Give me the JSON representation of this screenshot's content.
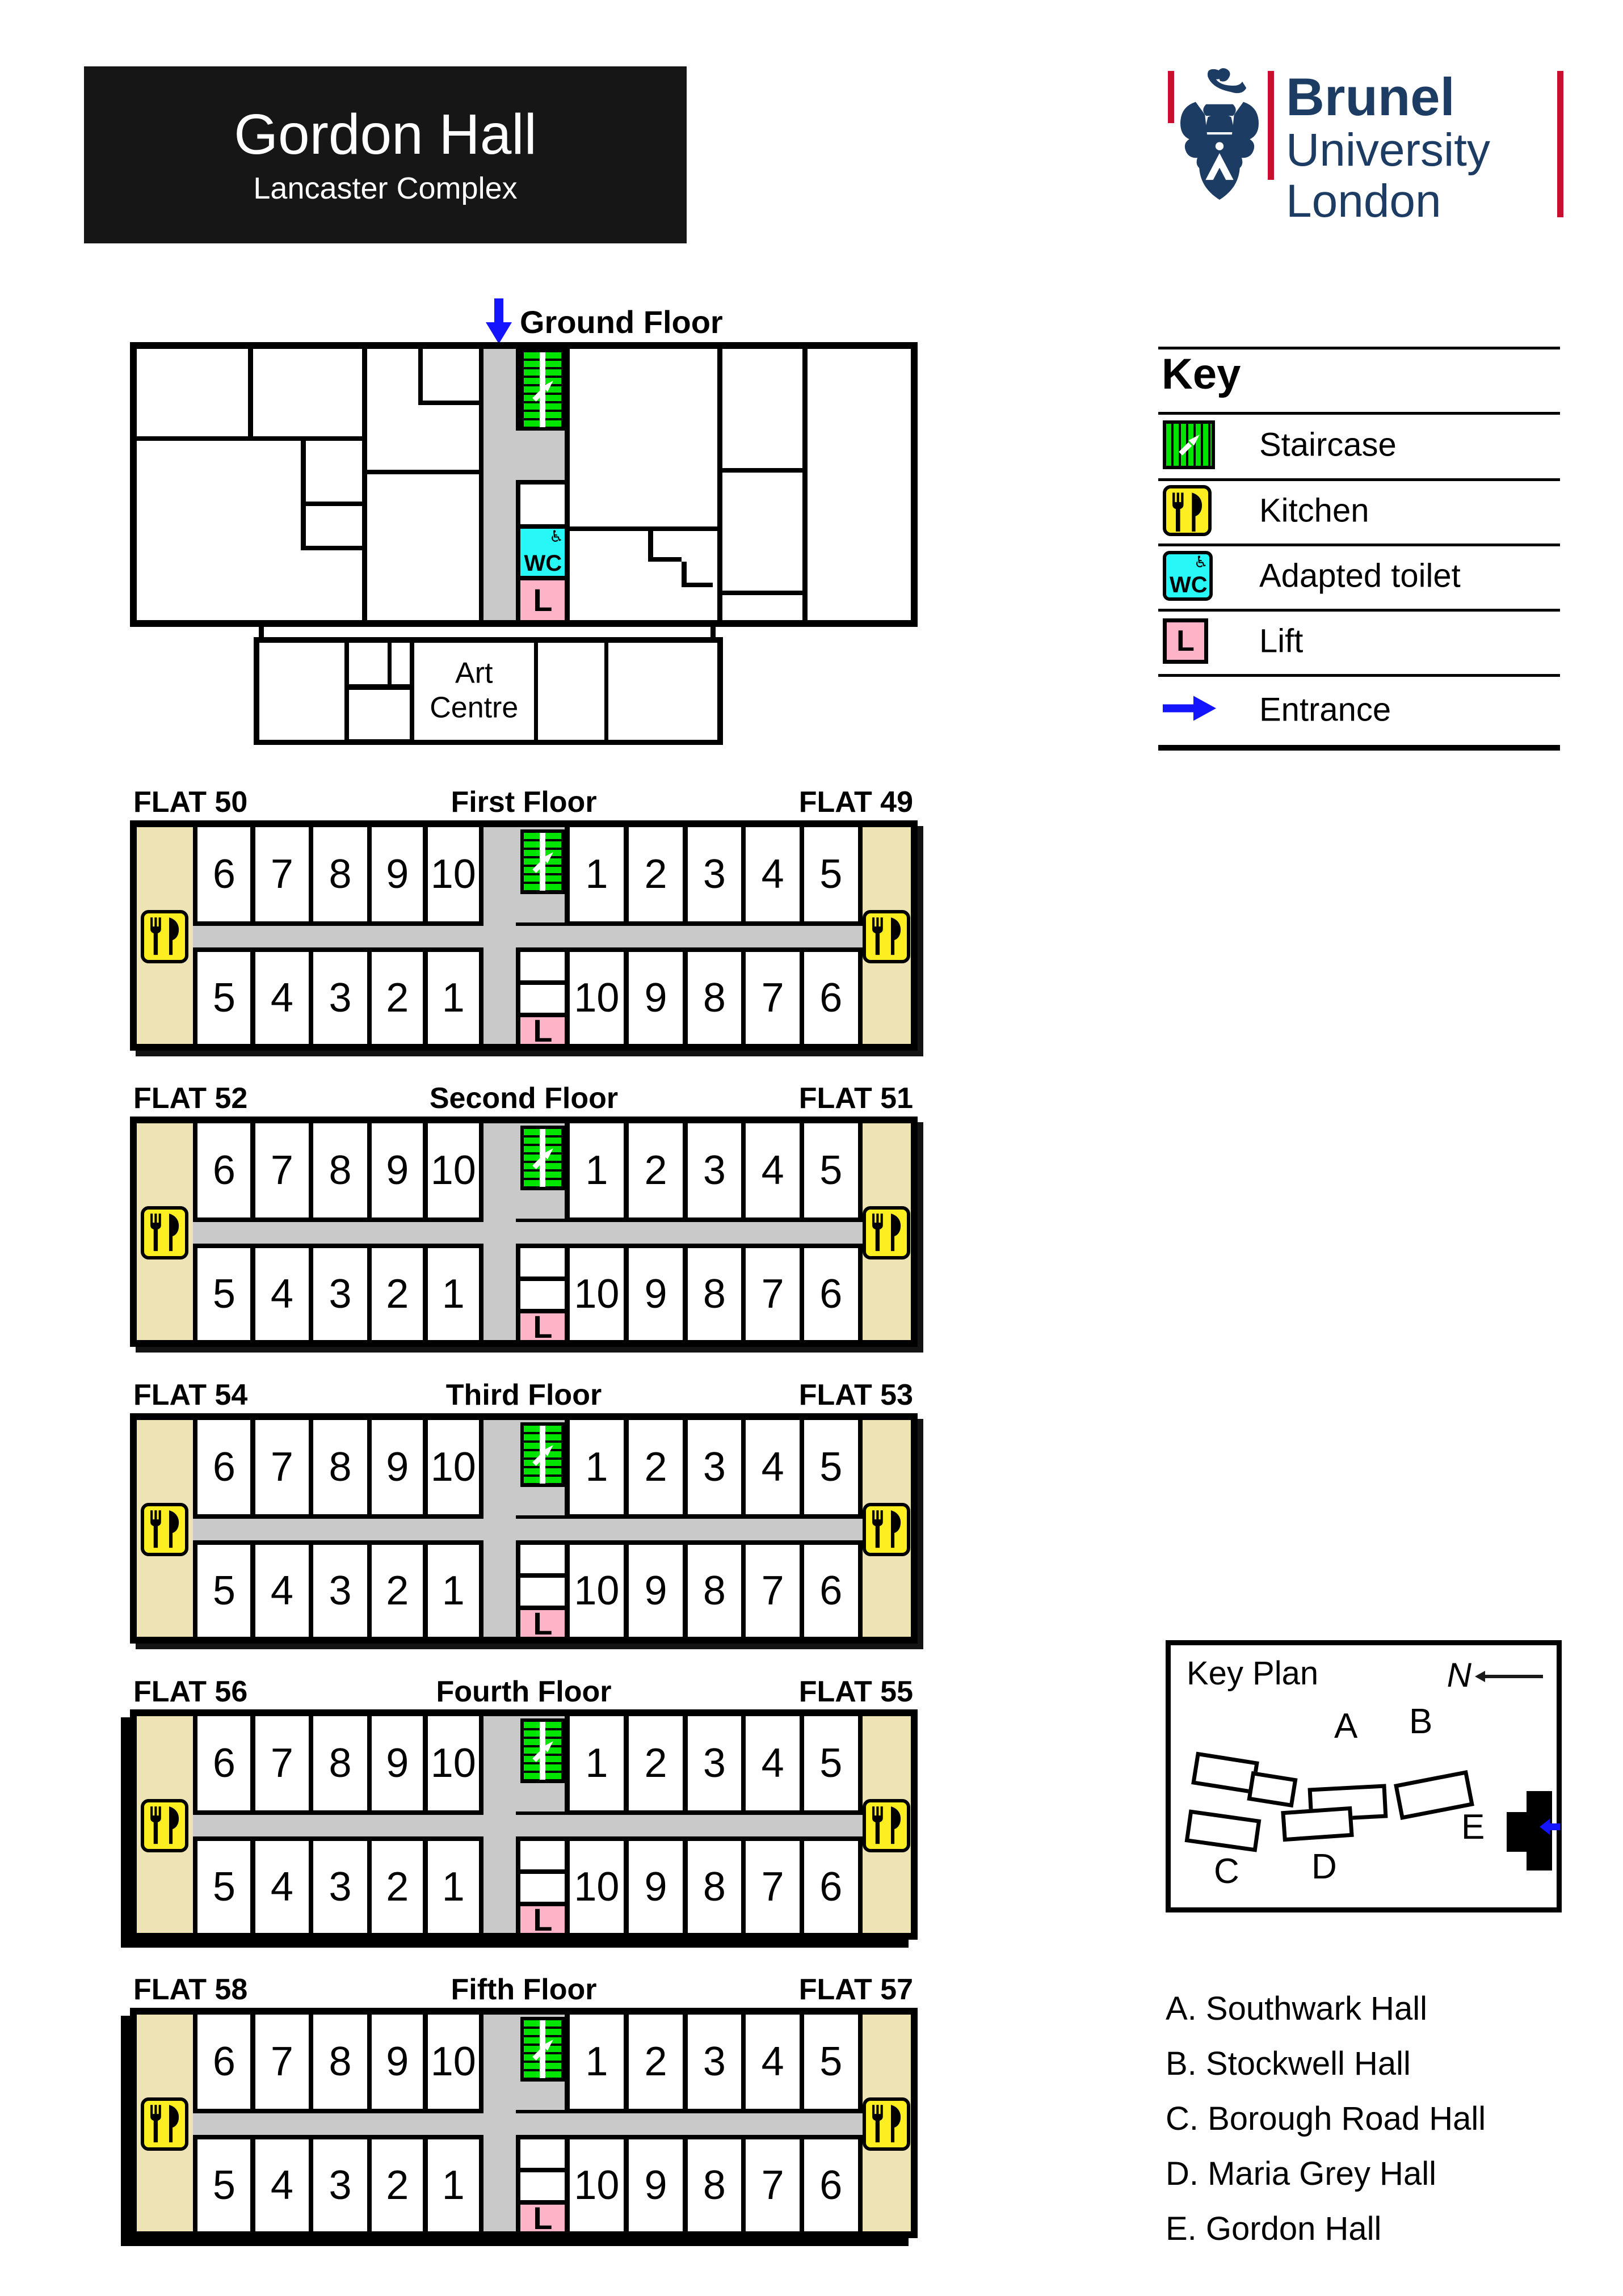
{
  "title_block": {
    "title": "Gordon Hall",
    "subtitle": "Lancaster Complex"
  },
  "logo": {
    "line1": "Brunel",
    "line2": "University",
    "line3": "London"
  },
  "ground_floor": {
    "label": "Ground Floor",
    "art_centre": "Art\nCentre",
    "wc": "WC",
    "lift": "L"
  },
  "key": {
    "title": "Key",
    "items": [
      {
        "id": "staircase",
        "label": "Staircase"
      },
      {
        "id": "kitchen",
        "label": "Kitchen"
      },
      {
        "id": "adapted-toilet",
        "label": "Adapted toilet"
      },
      {
        "id": "lift",
        "label": "Lift"
      },
      {
        "id": "entrance",
        "label": "Entrance"
      }
    ]
  },
  "floors": [
    {
      "flat_left": "FLAT 50",
      "title": "First Floor",
      "flat_right": "FLAT 49"
    },
    {
      "flat_left": "FLAT 52",
      "title": "Second Floor",
      "flat_right": "FLAT 51"
    },
    {
      "flat_left": "FLAT 54",
      "title": "Third Floor",
      "flat_right": "FLAT 53"
    },
    {
      "flat_left": "FLAT 56",
      "title": "Fourth Floor",
      "flat_right": "FLAT 55"
    },
    {
      "flat_left": "FLAT 58",
      "title": "Fifth Floor",
      "flat_right": "FLAT 57"
    }
  ],
  "rooms": {
    "top_left": [
      "6",
      "7",
      "8",
      "9",
      "10"
    ],
    "top_right": [
      "1",
      "2",
      "3",
      "4",
      "5"
    ],
    "bottom_left": [
      "5",
      "4",
      "3",
      "2",
      "1"
    ],
    "bottom_right": [
      "10",
      "9",
      "8",
      "7",
      "6"
    ],
    "lift": "L"
  },
  "key_plan": {
    "title": "Key Plan",
    "north": "N",
    "buildings": [
      "A",
      "B",
      "C",
      "D",
      "E"
    ]
  },
  "halls": [
    "A. Southwark Hall",
    "B. Stockwell Hall",
    "C. Borough Road Hall",
    "D. Maria Grey Hall",
    "E. Gordon Hall"
  ],
  "colors": {
    "beige": "#EDE3B4",
    "gray": "#C9C9C9",
    "green": "#00E400",
    "yellow": "#FCEE21",
    "cyan": "#28F7F7",
    "pink": "#FFB3C7",
    "blue": "#1414FF",
    "navy": "#1D3C63",
    "red": "#C8102E",
    "title_bg": "#161616"
  }
}
